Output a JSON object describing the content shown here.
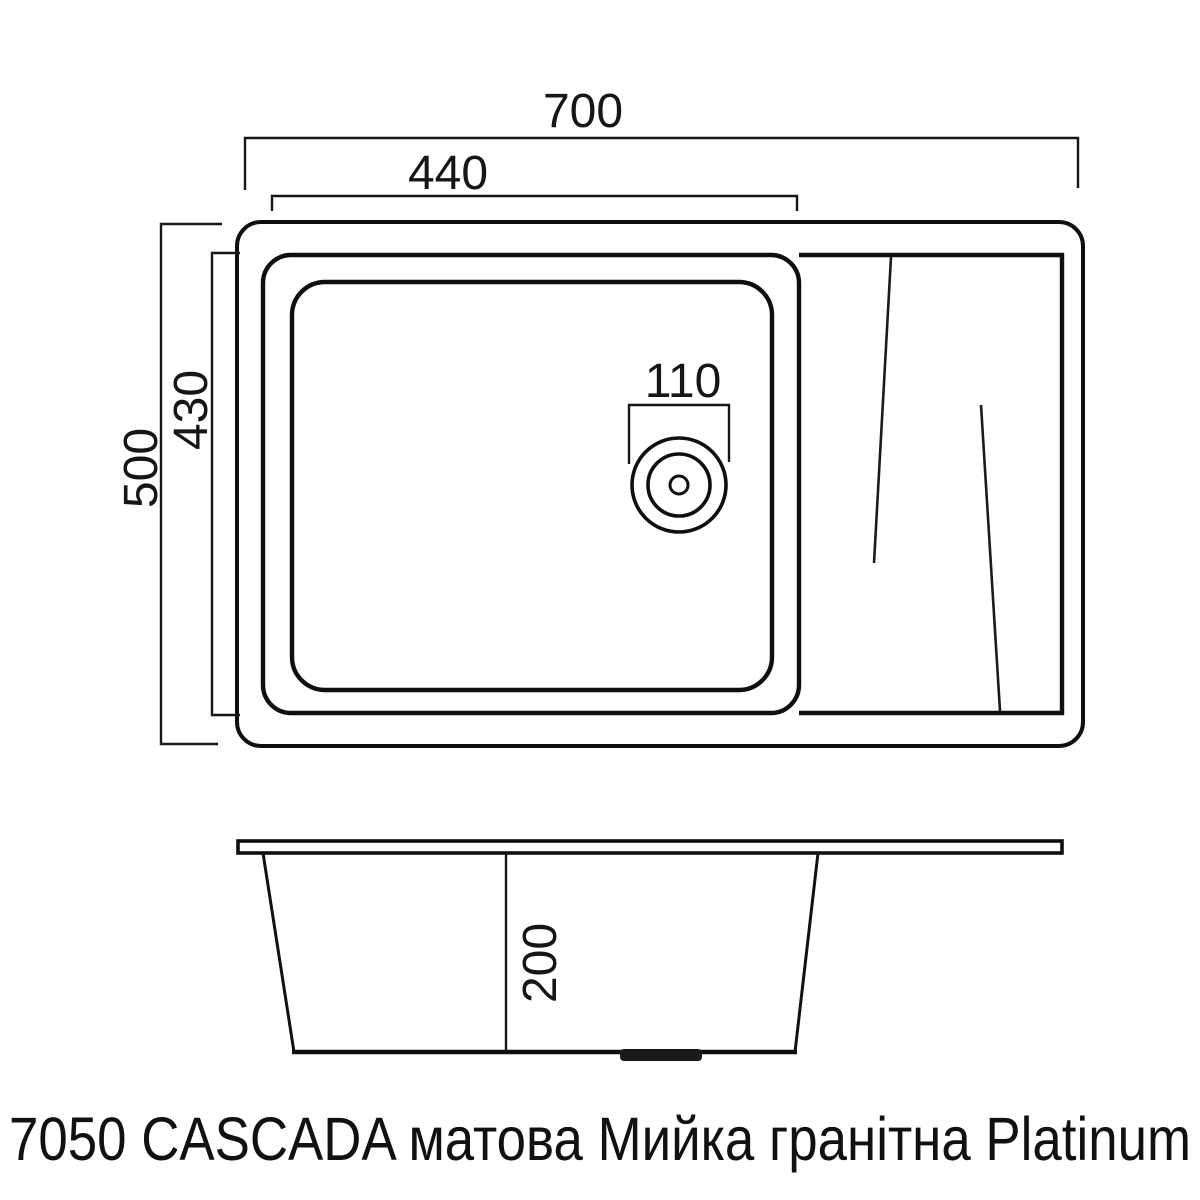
{
  "caption": "7050 CASCADA матова Мийка гранітна Platinum",
  "dimensions": {
    "top_view": {
      "overall_width": "700",
      "basin_inner_width": "440",
      "overall_depth": "500",
      "basin_inner_depth": "430",
      "drain_diameter": "110"
    },
    "section_view": {
      "bowl_depth": "200"
    }
  },
  "colors": {
    "line": "#141414",
    "background": "#ffffff"
  }
}
